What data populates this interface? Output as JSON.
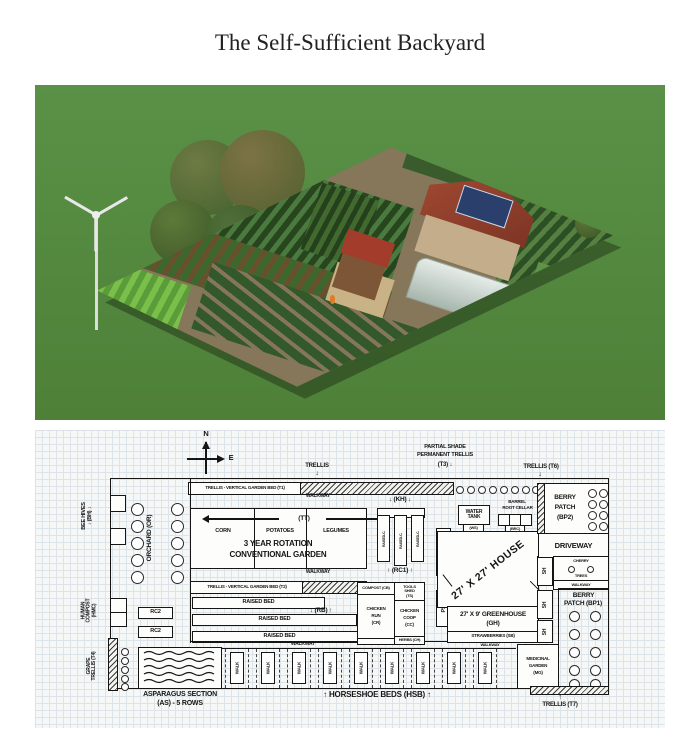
{
  "page": {
    "title": "The Self-Sufficient Backyard"
  },
  "photo": {
    "description": "3D rendering of a self-sufficient backyard homestead on a lawn",
    "colors": {
      "grass": "#52863f",
      "path": "#86765a",
      "roof": "#9c4530",
      "solar": "#2b3f6d",
      "greenhouse": "#dce8e4",
      "crops_dark": "#27461d",
      "crops_light": "#79bf4a"
    }
  },
  "plan": {
    "compass": {
      "n": "N",
      "e": "E"
    },
    "trellis_top": "TRELLIS",
    "t1": "TRELLIS - VERTICAL GARDEN BED (T1)",
    "t2": "TRELLIS - VERTICAL GARDEN BED (T2)",
    "t3_l1": "PARTIAL SHADE",
    "t3_l2": "PERMANENT TRELLIS",
    "t3_l3": "(T3) ↓",
    "t6": "TRELLIS (T6)",
    "bee_l1": "BEE HIVES",
    "bee_l2": "↓ (BH) ↓",
    "orchard": "ORCHARD (OR)",
    "walkway": "WALKWAY",
    "tt": "(TT)",
    "corn": "CORN",
    "potatoes": "POTATOES",
    "legumes": "LEGUMES",
    "rot_l1": "3 YEAR ROTATION",
    "rot_l2": "CONVENTIONAL GARDEN",
    "raised_bed": "RAISED BED",
    "rb": "↓ (RB) ↑",
    "hmc_l1": "HUMAN",
    "hmc_l2": "COMPOST",
    "hmc_l3": "(HMC)",
    "rc2": "RC2",
    "grape_l1": "GRAPE",
    "grape_l2": "TRELLIS (T4)",
    "asp_l1": "ASPARAGUS SECTION",
    "asp_l2": "(AS) - 5 ROWS",
    "walk": "WALK",
    "hsb": "↑ HORSESHOE BEDS (HSB) ↑",
    "kh": "↓ (KH) ↓",
    "raised_c": "RAISED-C.",
    "rc1": "↑ (RC1) ↑",
    "cb": "COMPOST (CB)",
    "ts_l1": "TOOLS",
    "ts_l2": "SHED",
    "ts_l3": "(TS)",
    "cr_l1": "CHICKEN",
    "cr_l2": "RUN",
    "cr_l3": "(CR)",
    "cc_l1": "CHICKEN",
    "cc_l2": "COOP",
    "cc_l3": "(CC)",
    "herbs": "HERBS (CH)",
    "ps": "PS",
    "water_l1": "WATER",
    "water_l2": "TANK",
    "ws": "(WS)",
    "brc_l1": "BARREL",
    "brc_l2": "ROOT CELLAR",
    "brc": "(BRC)",
    "house": "27' X 27' HOUSE",
    "gh_l1": "27' X 9' GREENHOUSE",
    "gh_l2": "(GH)",
    "sb": "STRAWBERRIES (SB)",
    "sh": "SH",
    "bp2_l1": "BERRY",
    "bp2_l2": "PATCH",
    "bp2_l3": "(BP2)",
    "driveway": "DRIVEWAY",
    "cherry": "CHERRY",
    "trees": "TREES",
    "bp1_l1": "BERRY",
    "bp1_l2": "PATCH (BP1)",
    "mg_l1": "MEDICINAL",
    "mg_l2": "GARDEN",
    "mg_l3": "(MG)",
    "t7": "TRELLIS (T7)",
    "t7_arrow": "↑"
  }
}
